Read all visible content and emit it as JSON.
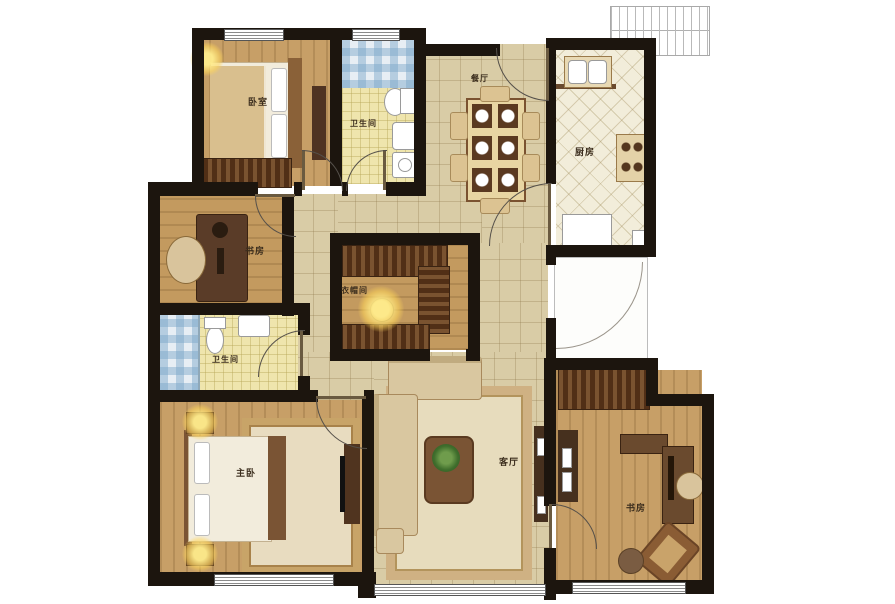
{
  "floorplan": {
    "rooms": [
      {
        "id": "bedroom-top",
        "label": "卧室"
      },
      {
        "id": "bath-top",
        "label": "卫生间"
      },
      {
        "id": "dining",
        "label": "餐厅"
      },
      {
        "id": "kitchen",
        "label": "厨房"
      },
      {
        "id": "study-left",
        "label": "书房"
      },
      {
        "id": "closet",
        "label": "衣帽间"
      },
      {
        "id": "bath-mid",
        "label": "卫生间"
      },
      {
        "id": "master",
        "label": "主卧"
      },
      {
        "id": "living",
        "label": "客厅"
      },
      {
        "id": "study-right",
        "label": "书房"
      }
    ],
    "colors": {
      "wall": "#1c150e",
      "wood_floor": "#c79f67",
      "hall_tile": "#d9cca6",
      "bath_tile": "#efe5ad",
      "kitchen_tile": "#f2edda",
      "furniture_dark": "#5d3a20",
      "lamp_glow": "#ffe98a"
    }
  }
}
